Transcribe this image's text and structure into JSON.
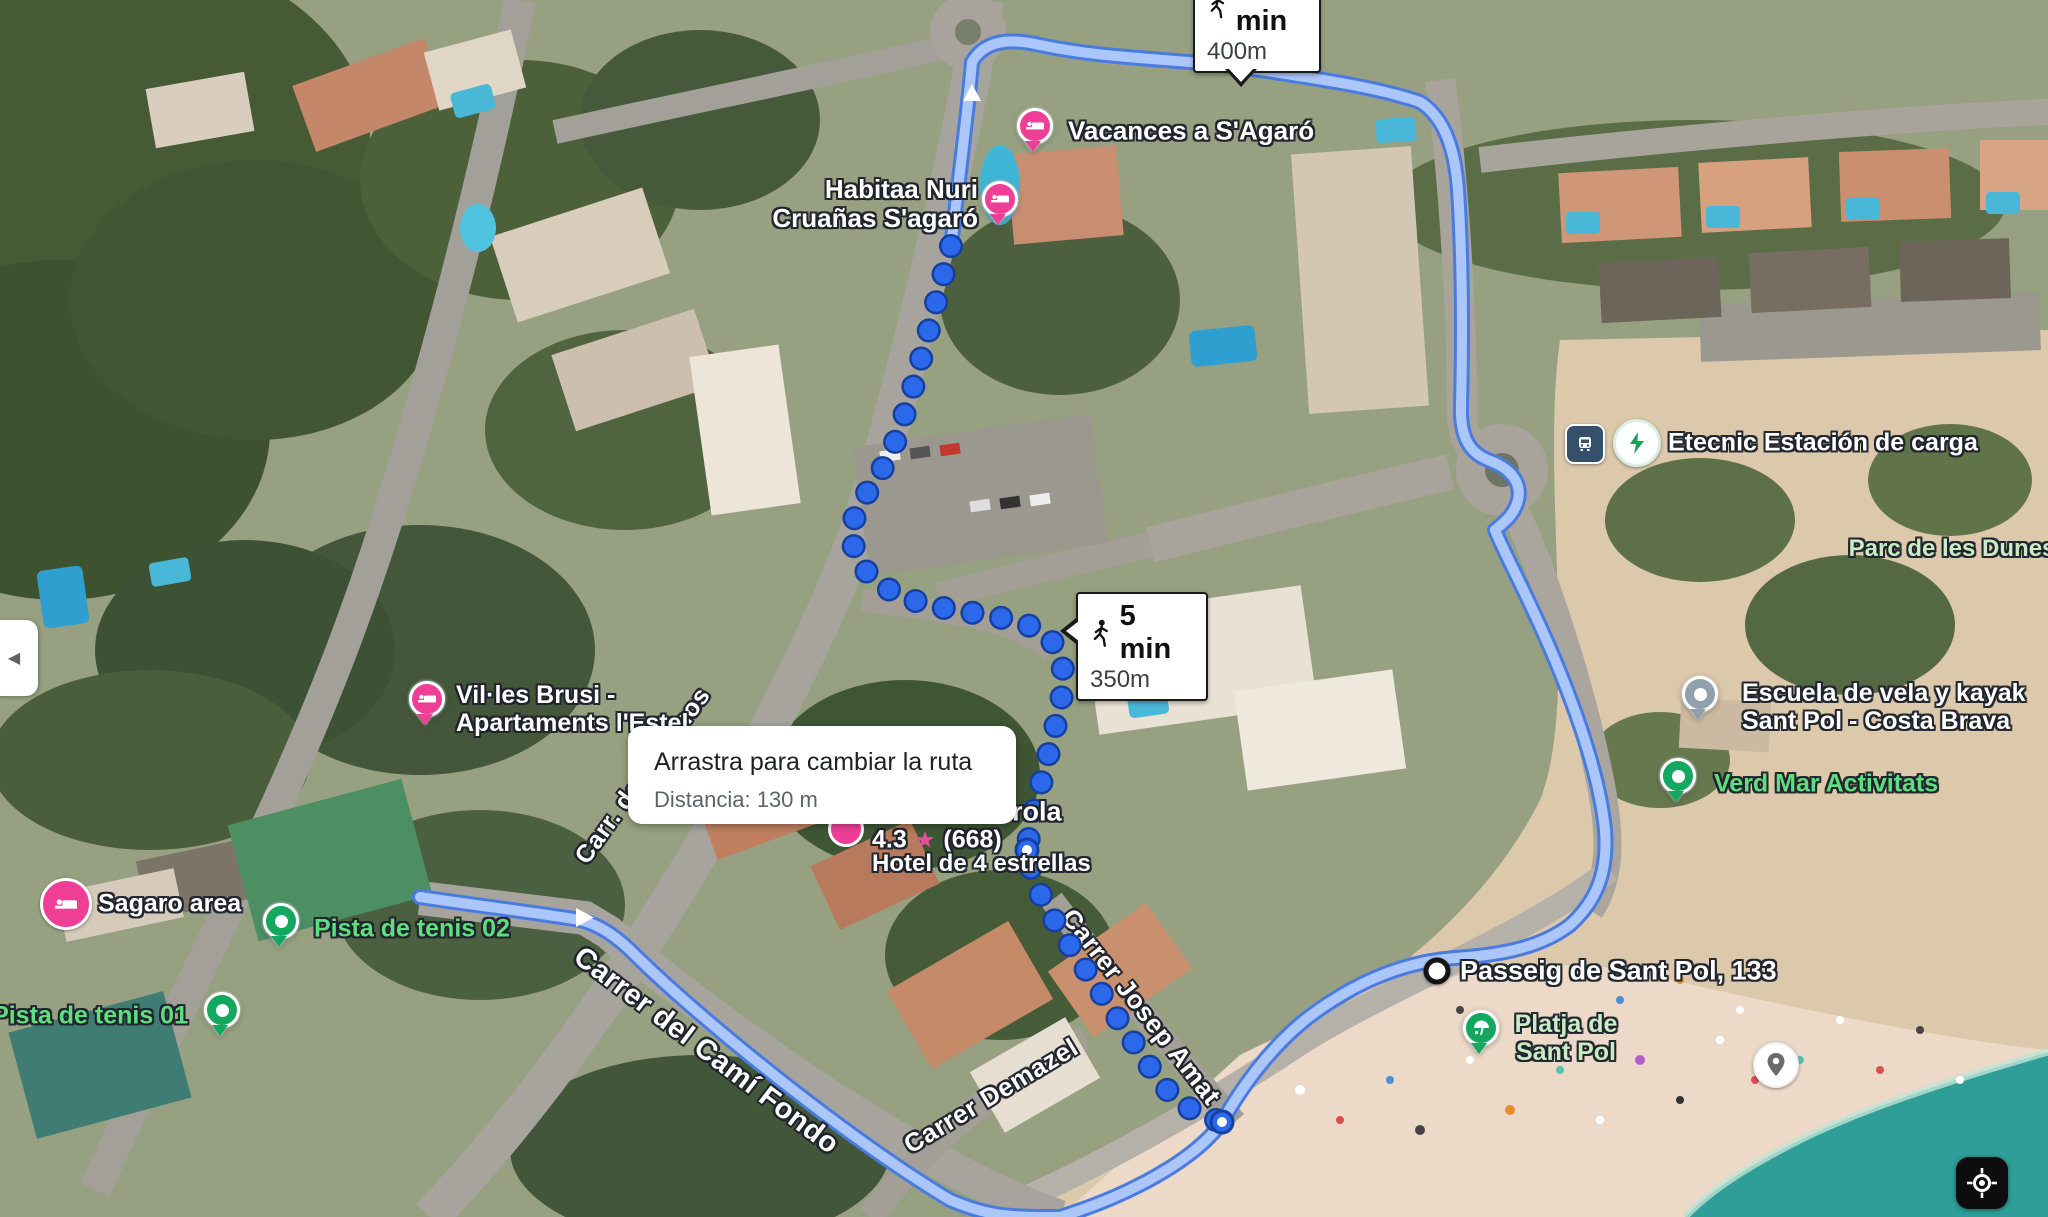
{
  "view": {
    "kind": "satellite-map-route",
    "mode": "walking"
  },
  "tooltip": {
    "title": "Arrastra para cambiar la ruta",
    "distance": "Distancia: 130 m"
  },
  "badges": {
    "top": {
      "time": "6 min",
      "distance": "400m",
      "icon": "walking-person"
    },
    "mid": {
      "time": "5 min",
      "distance": "350m",
      "icon": "walking-person"
    }
  },
  "destination": {
    "label": "Passeig de Sant Pol, 133"
  },
  "hotel": {
    "name_fragment": "rola",
    "rating": "4.3",
    "star": "★",
    "reviews": "(668)",
    "category": "Hotel de 4 estrellas"
  },
  "pois": {
    "vacances": "Vacances a S'Agaró",
    "habitaa_line1": "Habitaa Nuri",
    "habitaa_line2": "Cruañas S'agaró",
    "etecnic": "Etecnic Estación de carga",
    "parc_dunes": "Parc de les Dunes",
    "escuela_line1": "Escuela de vela y kayak",
    "escuela_line2": "Sant Pol - Costa Brava",
    "verd_mar": "Verd Mar Activitats",
    "villes_line1": "Vil·les Brusi -",
    "villes_line2": "Apartaments l'Estel",
    "sagaro": "Sagaro area",
    "tenis02": "Pista de tenis 02",
    "tenis01": "Pista de tenis 01",
    "platja_line1": "Platja de",
    "platja_line2": "Sant Pol"
  },
  "streets": {
    "verbania1": "Carrer Verbania",
    "verbania2": "Carrer Verbania",
    "av_top_partial": "Av. L",
    "vall_daro": "Av. Vall d'Aro",
    "av_jau_partial": "Av. Jau",
    "jaume": "Av. Jaume I",
    "via_tren1": "Carrer de la Via del Tren",
    "via_tren2": "Carrer de la Via del Tren",
    "so_partial": "só",
    "palamos_mid": "Carr. de Palamos",
    "palamos_hidden": "Carr. de Palamos",
    "palamos_big": "Carr. de Palamos",
    "cami_fondo": "Carrer del Camí Fondo",
    "demazel": "Carrer Demazel",
    "josep_amat": "Carrer Josep Amat"
  },
  "controls": {
    "collapse_arrow": "◀"
  },
  "colors": {
    "route_fill": "#abc6f8",
    "route_casing": "#4a7be0",
    "walk_dot": "#2c68ea",
    "walk_dot_ring": "#16409f",
    "hotel_pin": "#ef3e96",
    "green_pin": "#12a860",
    "gray_pin": "#90a0ac",
    "sea": "#2f9e98",
    "sand": "#dcc8ab",
    "ev_green": "#17a35b",
    "transit_navy": "#35506b"
  }
}
